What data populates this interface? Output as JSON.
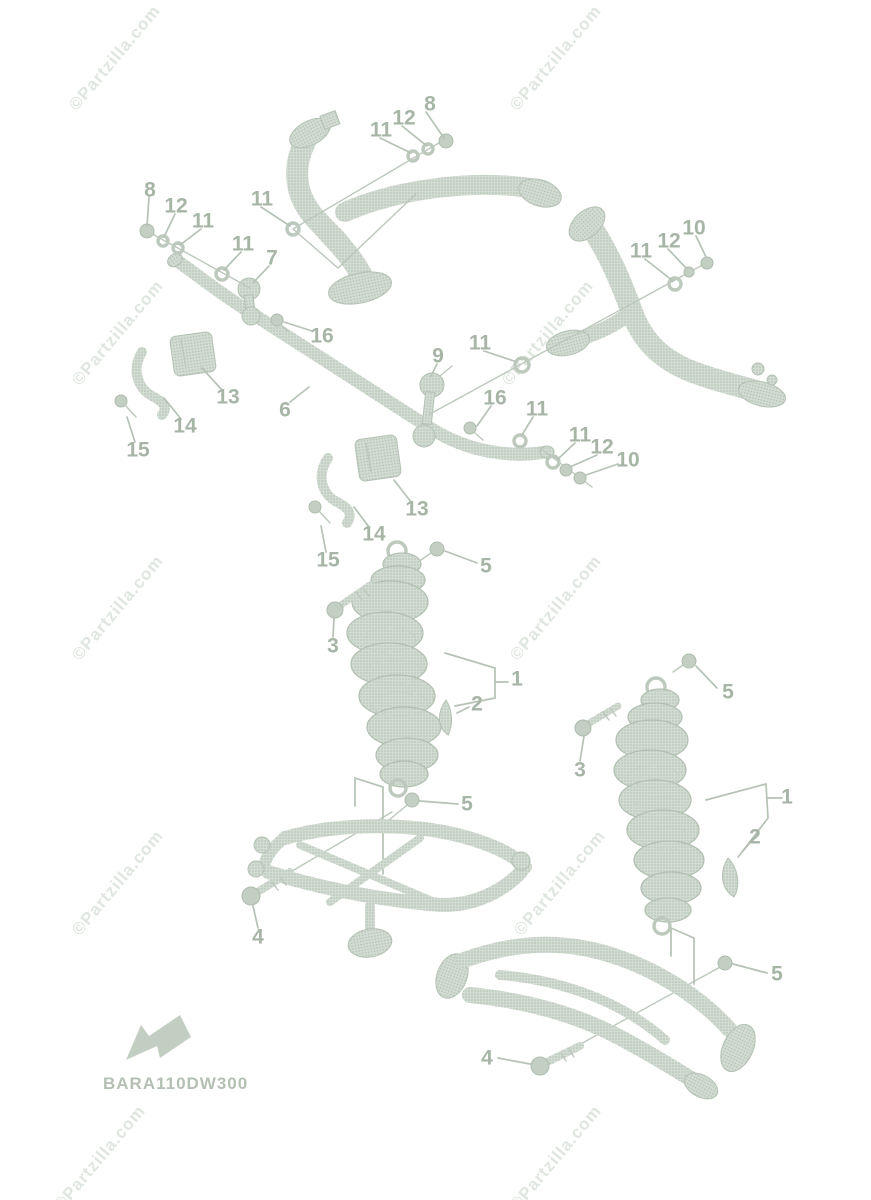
{
  "diagram": {
    "code": "BARA110DW300",
    "watermark_text": "©Partzilla.com",
    "direction_arrow": "front-direction-arrow",
    "colors": {
      "background": "#ffffff",
      "part_fill": "#ccd6cc",
      "part_dot": "#b2c0b2",
      "leader_line": "#b5c2b5",
      "callout_label": "#a7b5a7",
      "watermark": "#b0c1b0",
      "code_text": "#b3c0b3"
    },
    "callouts": [
      {
        "n": "8",
        "x": 430,
        "y": 104
      },
      {
        "n": "12",
        "x": 404,
        "y": 118
      },
      {
        "n": "11",
        "x": 381,
        "y": 130
      },
      {
        "n": "8",
        "x": 150,
        "y": 190
      },
      {
        "n": "12",
        "x": 176,
        "y": 206
      },
      {
        "n": "11",
        "x": 203,
        "y": 221
      },
      {
        "n": "11",
        "x": 262,
        "y": 199
      },
      {
        "n": "11",
        "x": 243,
        "y": 244
      },
      {
        "n": "7",
        "x": 272,
        "y": 258
      },
      {
        "n": "11",
        "x": 641,
        "y": 251
      },
      {
        "n": "12",
        "x": 669,
        "y": 241
      },
      {
        "n": "10",
        "x": 694,
        "y": 228
      },
      {
        "n": "9",
        "x": 438,
        "y": 356
      },
      {
        "n": "11",
        "x": 480,
        "y": 343
      },
      {
        "n": "16",
        "x": 322,
        "y": 336
      },
      {
        "n": "16",
        "x": 495,
        "y": 398
      },
      {
        "n": "11",
        "x": 537,
        "y": 409
      },
      {
        "n": "6",
        "x": 285,
        "y": 410
      },
      {
        "n": "13",
        "x": 228,
        "y": 397
      },
      {
        "n": "14",
        "x": 185,
        "y": 426
      },
      {
        "n": "15",
        "x": 138,
        "y": 450
      },
      {
        "n": "11",
        "x": 580,
        "y": 435
      },
      {
        "n": "12",
        "x": 602,
        "y": 447
      },
      {
        "n": "10",
        "x": 628,
        "y": 460
      },
      {
        "n": "13",
        "x": 417,
        "y": 509
      },
      {
        "n": "14",
        "x": 374,
        "y": 534
      },
      {
        "n": "15",
        "x": 328,
        "y": 560
      },
      {
        "n": "5",
        "x": 486,
        "y": 566
      },
      {
        "n": "3",
        "x": 333,
        "y": 646
      },
      {
        "n": "1",
        "x": 517,
        "y": 679
      },
      {
        "n": "2",
        "x": 477,
        "y": 704
      },
      {
        "n": "5",
        "x": 728,
        "y": 692
      },
      {
        "n": "3",
        "x": 580,
        "y": 770
      },
      {
        "n": "1",
        "x": 787,
        "y": 797
      },
      {
        "n": "2",
        "x": 755,
        "y": 837
      },
      {
        "n": "5",
        "x": 467,
        "y": 804
      },
      {
        "n": "4",
        "x": 258,
        "y": 937
      },
      {
        "n": "5",
        "x": 777,
        "y": 974
      },
      {
        "n": "4",
        "x": 487,
        "y": 1058
      }
    ],
    "watermarks": [
      {
        "x": 115,
        "y": 58
      },
      {
        "x": 556,
        "y": 58
      },
      {
        "x": 118,
        "y": 333
      },
      {
        "x": 548,
        "y": 333
      },
      {
        "x": 118,
        "y": 608
      },
      {
        "x": 556,
        "y": 608
      },
      {
        "x": 118,
        "y": 883
      },
      {
        "x": 560,
        "y": 883
      },
      {
        "x": 100,
        "y": 1158
      },
      {
        "x": 556,
        "y": 1158
      }
    ]
  }
}
